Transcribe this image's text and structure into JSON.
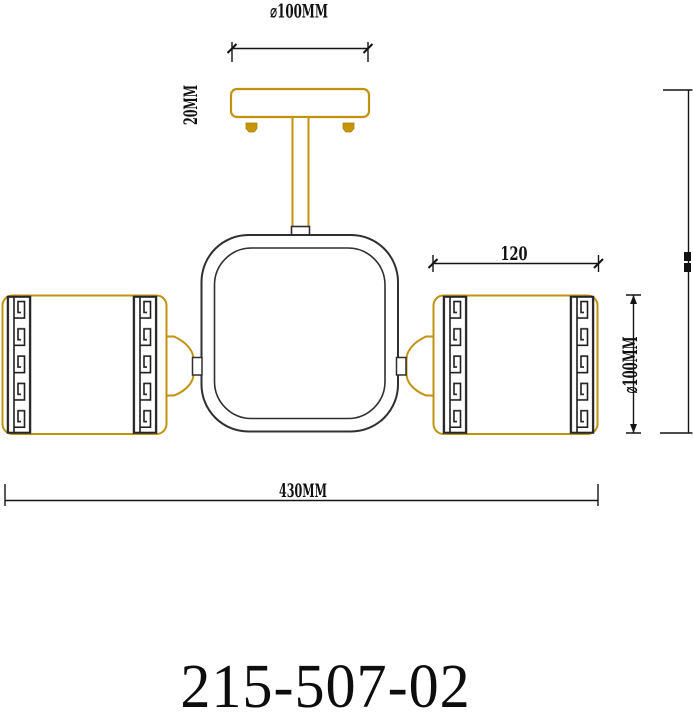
{
  "title": {
    "product_code": "215-507-02"
  },
  "drawing": {
    "kind": "ceiling-light-technical-drawing-front-elevation",
    "dimensions": {
      "canopy_diameter": "⌀100MM",
      "canopy_height": "20MM",
      "arm_length": "120",
      "shade_height": "⌀100MM",
      "overall_width": "430MM"
    },
    "colors": {
      "metal_outline": "#c0920e",
      "dark_line": "#2f2f2f",
      "dimension_line": "#141414"
    }
  }
}
